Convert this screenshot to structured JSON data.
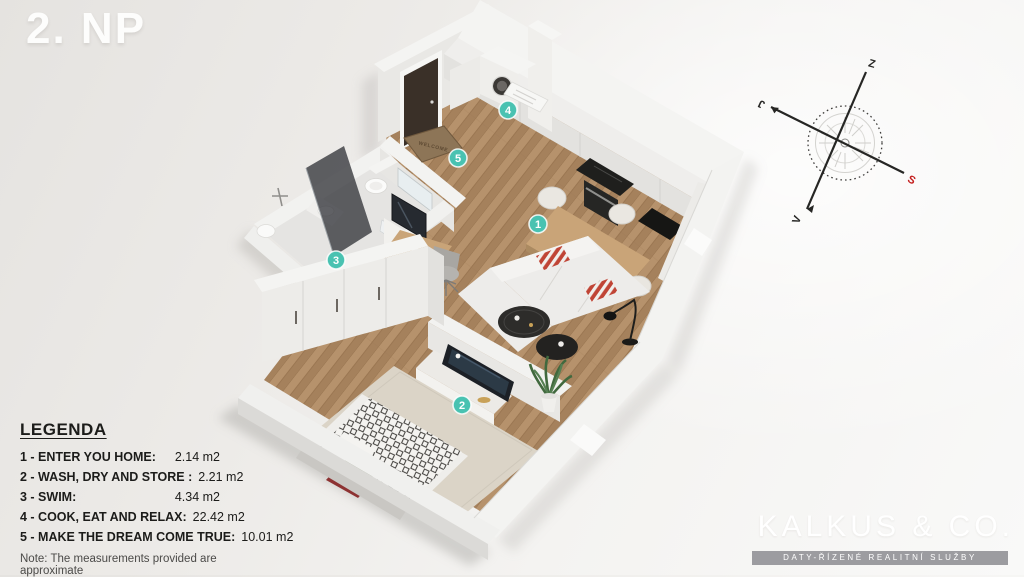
{
  "title": "2. NP",
  "legend": {
    "heading": "LEGENDA",
    "items": [
      {
        "label": "1 - ENTER YOU HOME:",
        "value": "2.14 m2"
      },
      {
        "label": "2 - WASH, DRY AND STORE :",
        "value": "2.21 m2"
      },
      {
        "label": "3 - SWIM:",
        "value": "4.34 m2"
      },
      {
        "label": "4 - COOK, EAT AND RELAX:",
        "value": "22.42 m2"
      },
      {
        "label": "5 - MAKE THE DREAM COME TRUE:",
        "value": "10.01 m2"
      }
    ],
    "note": "Note: The measurements provided are approximate"
  },
  "plan": {
    "markers": [
      "1",
      "2",
      "3",
      "4",
      "5"
    ],
    "welcome_mat": "WELCOME",
    "marker_color": "#49c2b1"
  },
  "compass": {
    "west": "Z",
    "north": "S",
    "east": "V",
    "south": "J",
    "north_color": "#c41e1e"
  },
  "brand": {
    "name": "KALKUS & CO.",
    "tagline": "DATY-ŘÍZENÉ REALITNÍ SLUŽBY"
  }
}
